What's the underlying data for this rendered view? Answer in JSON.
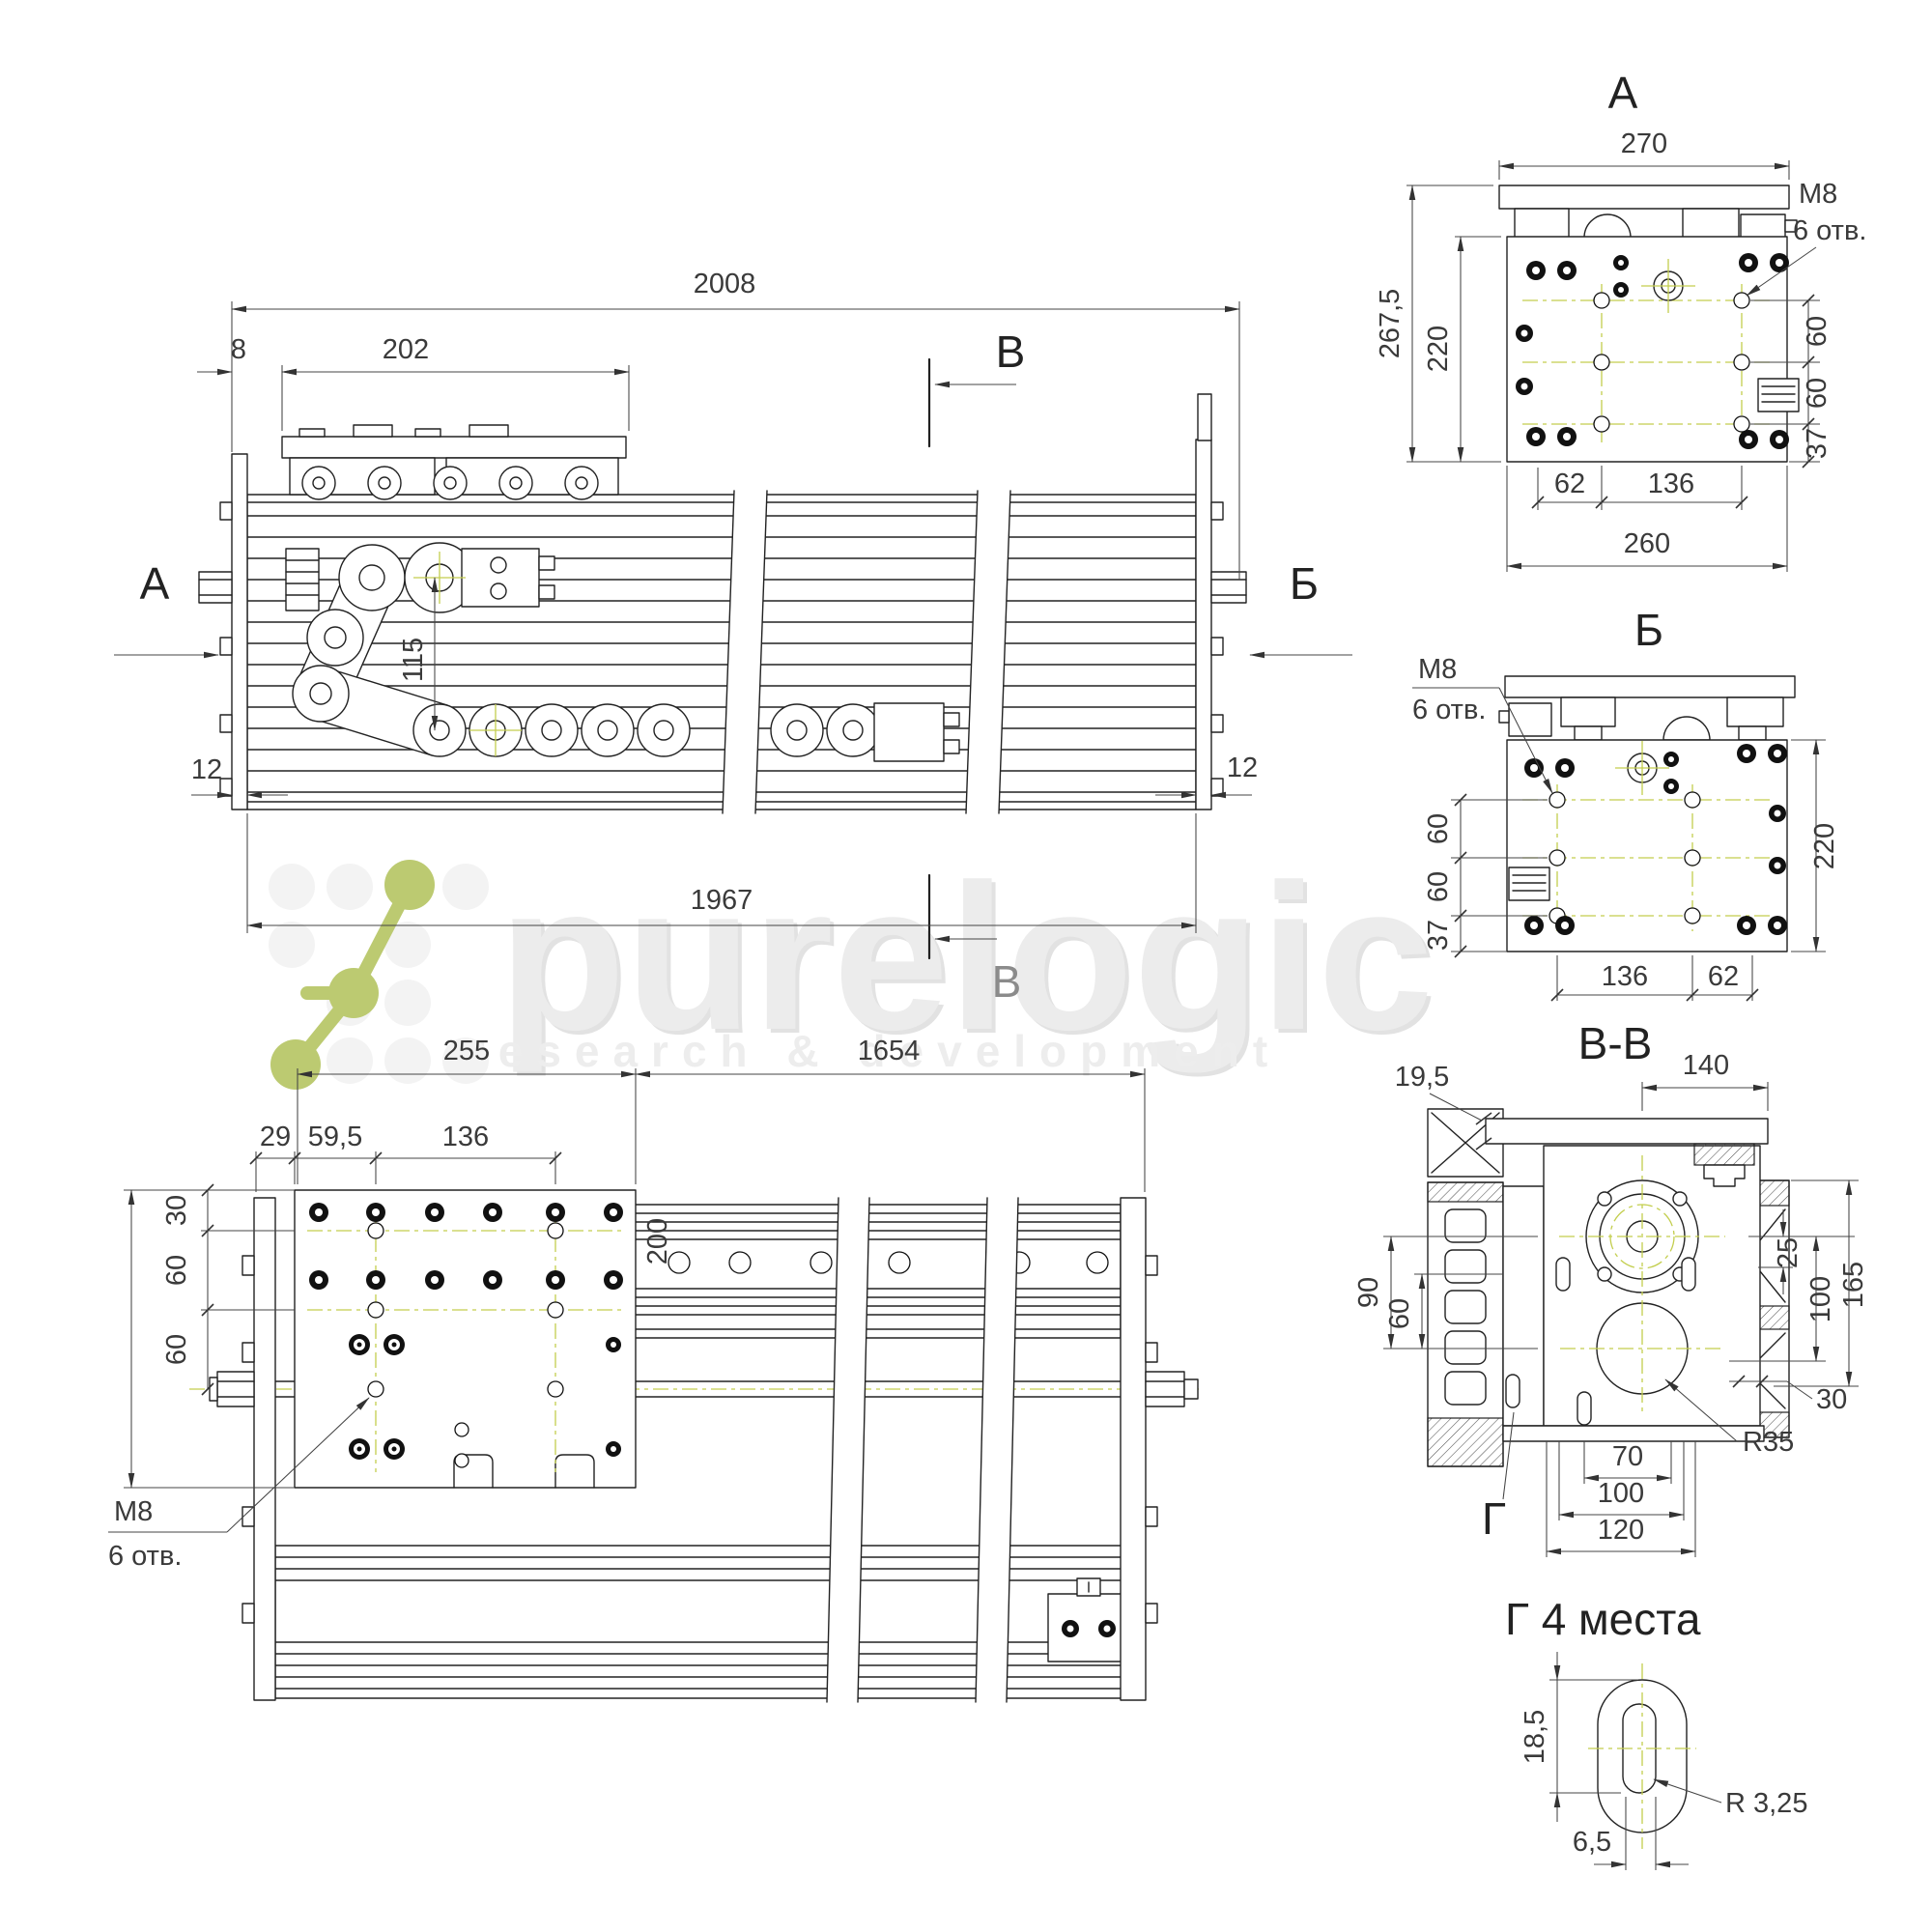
{
  "watermark": {
    "brand": "purelogic",
    "tagline": "research & development",
    "logo_color": "#bcca71"
  },
  "colors": {
    "line": "#222222",
    "dimension": "#444444",
    "centerline": "#c3ce4d",
    "watermark_gray": "#ececec"
  },
  "drawing": {
    "front": {
      "dim_2008": "2008",
      "dim_8": "8",
      "dim_202": "202",
      "dim_12_left": "12",
      "dim_12_right": "12",
      "dim_115": "115",
      "dim_1967": "1967",
      "label_a": "А",
      "label_b": "Б",
      "section_v_top": "В",
      "section_v_bottom": "В"
    },
    "view_a": {
      "title": "А",
      "dim_270": "270",
      "dim_267_5": "267,5",
      "dim_220": "220",
      "thread": "М8",
      "holes": "6 отв.",
      "dim_60_1": "60",
      "dim_60_2": "60",
      "dim_37": "37",
      "dim_62": "62",
      "dim_136": "136",
      "dim_260": "260"
    },
    "view_b": {
      "title": "Б",
      "thread": "М8",
      "holes": "6 отв.",
      "dim_60_1": "60",
      "dim_60_2": "60",
      "dim_37": "37",
      "dim_220": "220",
      "dim_136": "136",
      "dim_62": "62"
    },
    "top_view": {
      "dim_255": "255",
      "dim_1654": "1654",
      "dim_29": "29",
      "dim_59_5": "59,5",
      "dim_136": "136",
      "dim_30": "30",
      "dim_60_1": "60",
      "dim_60_2": "60",
      "dim_200": "200",
      "thread": "М8",
      "holes": "6 отв."
    },
    "section_vv": {
      "title": "В-В",
      "dim_140": "140",
      "dim_19_5": "19,5",
      "dim_90": "90",
      "dim_60": "60",
      "dim_25": "25",
      "dim_100_right": "100",
      "dim_165": "165",
      "dim_30": "30",
      "dim_70": "70",
      "dim_100_bottom": "100",
      "dim_120": "120",
      "radius_r35": "R35",
      "label_g": "Г"
    },
    "detail_g": {
      "title": "Г 4 места",
      "dim_18_5": "18,5",
      "dim_6_5": "6,5",
      "radius": "R 3,25"
    }
  }
}
